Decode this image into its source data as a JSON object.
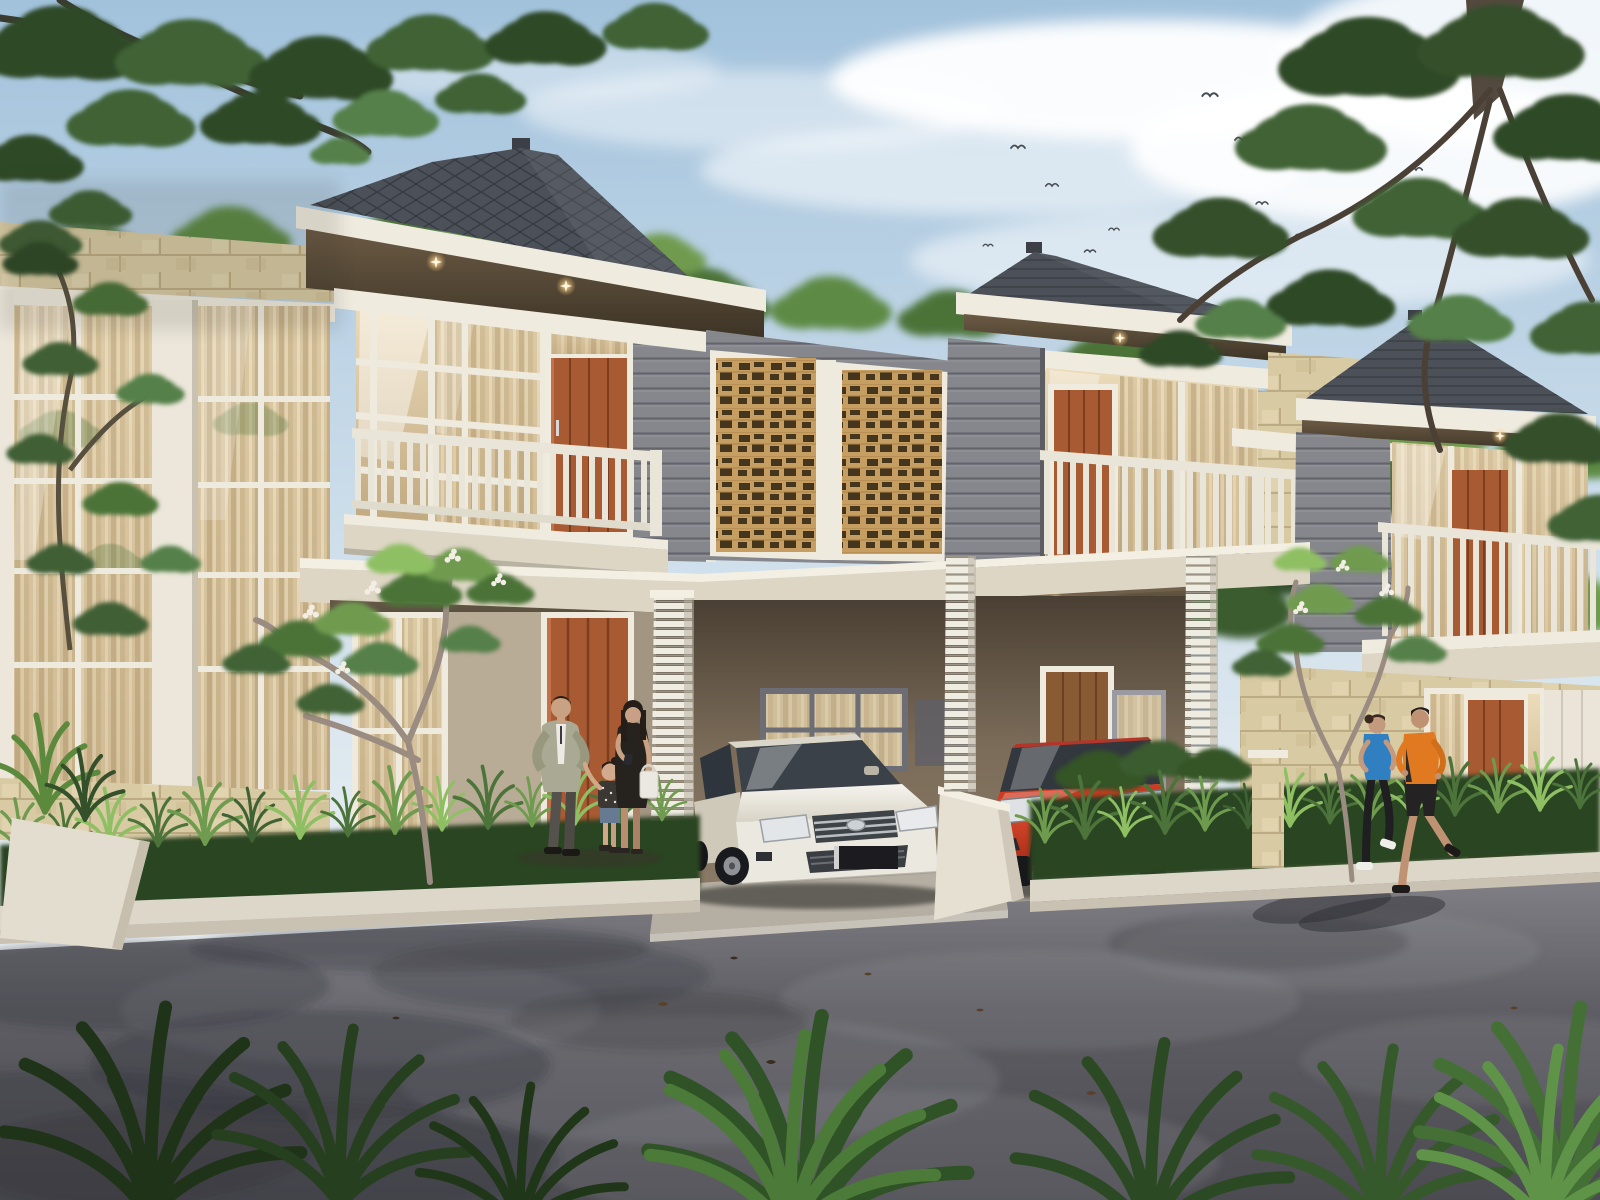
{
  "scene": {
    "title": "Architectural rendering of a row of modern two-storey tropical townhouses at dusk-lit daytime",
    "setting": "residential street with asphalt road, planted verges, frangipani trees, family by the front door and two joggers passing",
    "sky": {
      "condition": "partly cloudy",
      "birds_visible": 13
    },
    "palette": {
      "sky_top": "#a2c2dc",
      "sky_mid": "#cfdfeb",
      "sky_low": "#eef2f4",
      "cloud": "#ffffff",
      "roof": "#4c5058",
      "roof_hi": "#6d737c",
      "roof_line": "#34383f",
      "fascia": "#f0ebdf",
      "fascia_shade": "#d9d2c2",
      "soffit_hi": "#6b5a44",
      "soffit_lo": "#3d3426",
      "plank": "#86868d",
      "plank_line": "#63636a",
      "stone": "#d8caa3",
      "stone_line": "#bdab83",
      "stone_hi": "#e7dcba",
      "lattice": "#c79e61",
      "lattice_dark": "#46351d",
      "glass_hi": "#ecdcba",
      "glass_lo": "#bfa67d",
      "glass_dark": "#3a4149",
      "curtain_base": "#d7c49f",
      "door": "#a85a32",
      "door_dark": "#7c3e20",
      "door_hi": "#c4714a",
      "rail": "#e9e5d9",
      "rail_shade": "#b8b2a2",
      "slab": "#e8e2d4",
      "slab_face": "#ded6c5",
      "interior": "#7b6c59",
      "interior_dark": "#54483a",
      "floor_tile": "#b5afa3",
      "curb": "#ddd7c9",
      "curb_face": "#c9c2b2",
      "road_top": "#84848a",
      "road_mid": "#5d5d63",
      "road_dark": "#4b4b51",
      "road_shadow": "#33333a",
      "road_light": "#a3a3a8",
      "foliage_dark": "#33502b",
      "foliage_mid": "#4c7339",
      "foliage_light": "#6f9b4f",
      "foliage_bright": "#8fbf63",
      "trunk": "#6e655c",
      "branch_pale": "#9a8c80",
      "glow": "#ffe9b0",
      "red_hi": "#e25030",
      "red_lo": "#a12614",
      "skin": "#c9a183",
      "hair": "#241d18"
    },
    "houses": [
      {
        "name": "townhouse-left",
        "storeys": 2,
        "roof": "dark hip roof with diamond tiles",
        "features": "glazed upper facade, balcony with vertical slats, orange timber doors, grey plank siding, eave downlights"
      },
      {
        "name": "townhouse-middle",
        "storeys": 2,
        "roof": "dark hip roof",
        "features": "tan breeze-block lattice screens, corner plank column, balcony, orange door, double carport below"
      },
      {
        "name": "townhouse-right",
        "storeys": 2,
        "roof": "dark hip roof",
        "features": "stone base, balcony, orange door, white framed windows"
      }
    ],
    "lattice_screens": {
      "count": 2,
      "material": "tan timber breeze blocks"
    },
    "carport": {
      "bays": 2,
      "downlights": 4,
      "pillars": "white louvred posts"
    },
    "vehicles": [
      {
        "name": "white-sedan",
        "type": "sedan",
        "brand_badge": "Toyota",
        "color": "#ebe8df",
        "plate": "dark unreadable"
      },
      {
        "name": "red-hatchback",
        "type": "hatchback",
        "brand_badge": "Toyota",
        "color": "#cf3b22",
        "plate": "small blue"
      }
    ],
    "people": [
      {
        "name": "father",
        "outfit": "sage jacket, white shirt, grey trousers",
        "top_color": "#a9a994"
      },
      {
        "name": "mother",
        "outfit": "black dress, white shopping bag",
        "top_color": "#26231f"
      },
      {
        "name": "daughter",
        "outfit": "patterned tee, denim shorts",
        "top_color": "#3b3733"
      },
      {
        "name": "jogger-woman",
        "outfit": "blue tank, black leggings, white shoes",
        "top_color": "#2f7fc1"
      },
      {
        "name": "jogger-man",
        "outfit": "orange jacket, black shorts",
        "top_color": "#e0791f"
      }
    ],
    "vegetation": [
      "overhanging leafy tree top-left",
      "large tree with trunk top-right",
      "background tree line behind roofs",
      "two frangipani trees with white blooms",
      "fern planting strips with white curbs",
      "dark palm rosettes along bottom edge"
    ],
    "road": {
      "surface": "asphalt",
      "details": "tree shadows, worn light patches, scattered fallen leaves"
    }
  }
}
